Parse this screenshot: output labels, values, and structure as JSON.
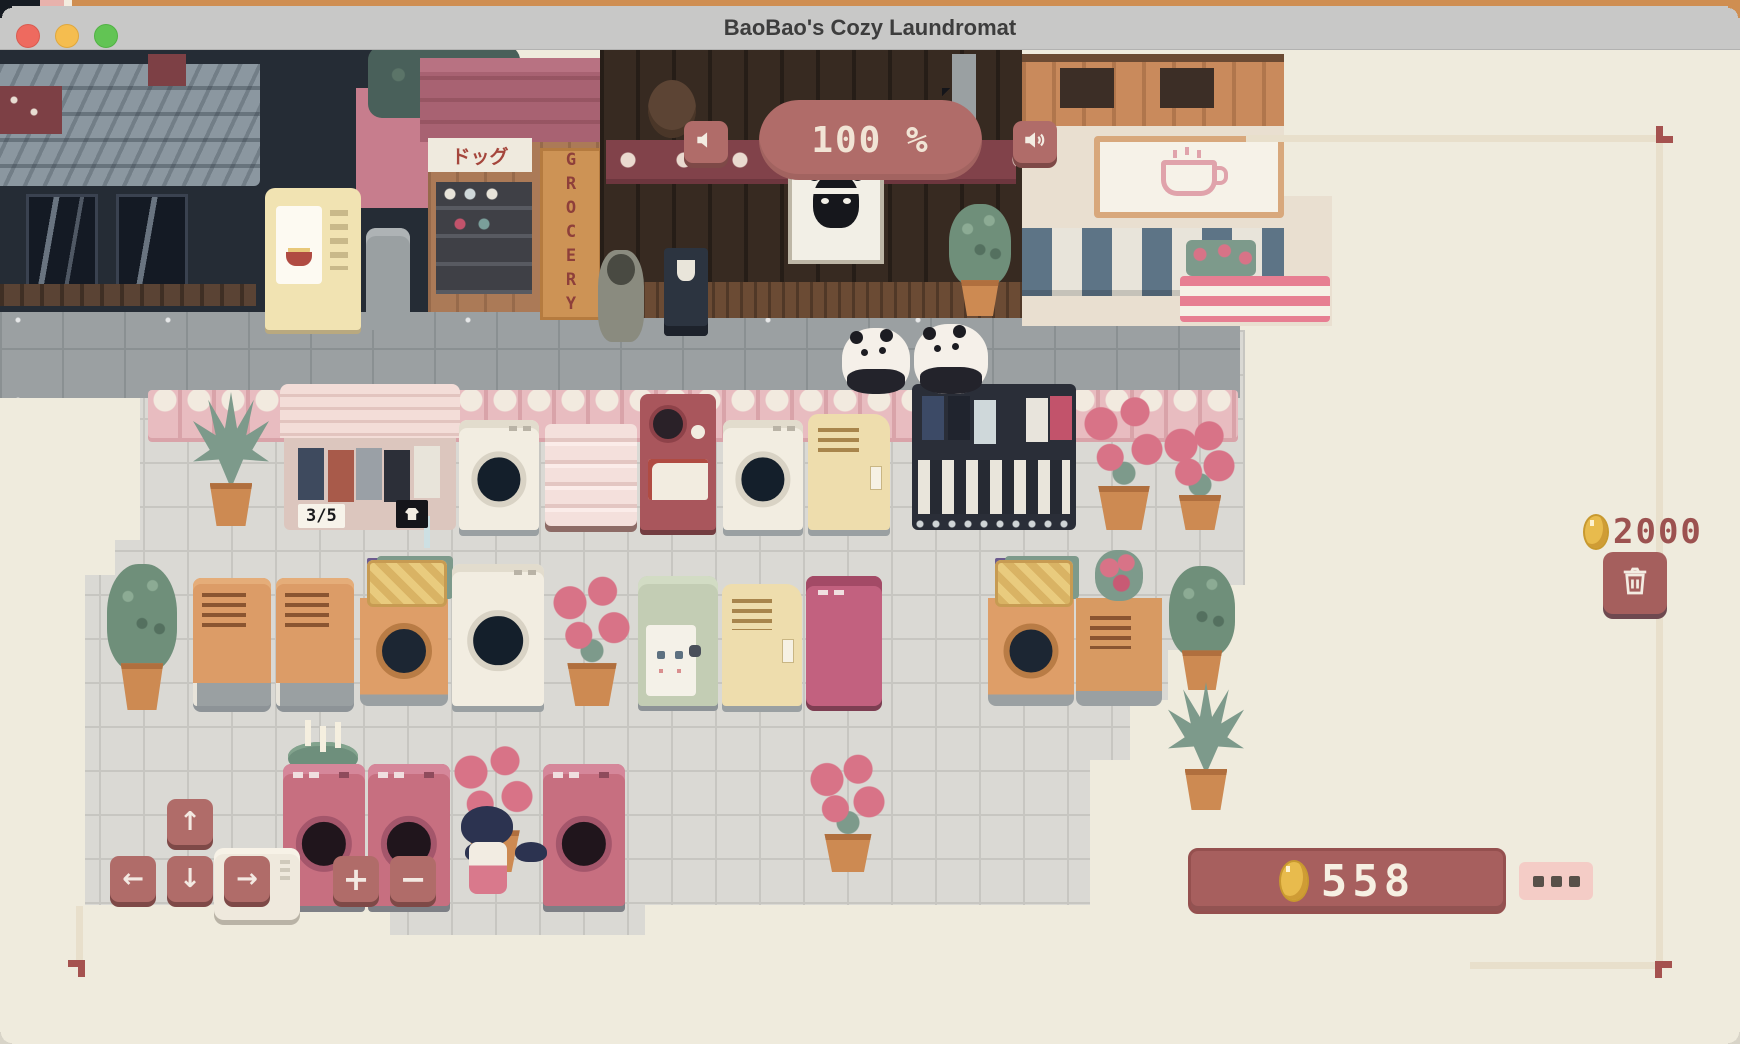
{
  "window": {
    "title": "BaoBao's Cozy Laundromat",
    "traffic_lights": [
      "close",
      "minimize",
      "zoom"
    ]
  },
  "hud": {
    "volume_percent": "100 %",
    "balance_top": "2000",
    "wallet_balance": "558",
    "shop_stock": "3/5",
    "icons": [
      "speaker-muted-icon",
      "speaker-on-icon",
      "coin-icon",
      "trash-icon",
      "ellipsis-icon"
    ]
  },
  "controls": {
    "up": "↑",
    "down": "↓",
    "left": "←",
    "right": "→",
    "plus": "+",
    "minus": "−"
  },
  "signs": {
    "grocery_vertical": "GROCERY",
    "katakana_sign": "ドッグ"
  },
  "colors": {
    "hud_red": "#a75f5e",
    "hud_button": "#b06c69",
    "coin_gold": "#e8bb4d",
    "balance_text": "#9c5250",
    "fence_pink": "#e8bcc0",
    "floor_gray": "#dad9d4",
    "sidewalk_gray": "#9ba0a2",
    "background_beige": "#efebdd",
    "bracket_red": "#a5524f"
  },
  "scene": {
    "props": [
      {
        "name": "agave-plant",
        "type": "agave",
        "x": 193,
        "y": 392,
        "w": 76,
        "h": 134
      },
      {
        "name": "clothes-shop",
        "type": "shop",
        "x": 284,
        "y": 384,
        "w": 172,
        "h": 146,
        "label": "3/5"
      },
      {
        "name": "washer",
        "type": "washer",
        "x": 459,
        "y": 420,
        "w": 80,
        "h": 110
      },
      {
        "name": "pink-shelf",
        "type": "shelf",
        "x": 545,
        "y": 424,
        "w": 92,
        "h": 102
      },
      {
        "name": "red-vending-machine",
        "type": "vend-red",
        "x": 640,
        "y": 394,
        "w": 76,
        "h": 136
      },
      {
        "name": "washer",
        "type": "washer",
        "x": 723,
        "y": 420,
        "w": 80,
        "h": 110
      },
      {
        "name": "cream-cabinet",
        "type": "locker",
        "x": 808,
        "y": 414,
        "w": 82,
        "h": 116
      },
      {
        "name": "changing-room",
        "type": "changing",
        "x": 912,
        "y": 384,
        "w": 164,
        "h": 146
      },
      {
        "name": "flower-planter",
        "type": "flowers",
        "x": 1078,
        "y": 392,
        "w": 92,
        "h": 138
      },
      {
        "name": "flower-planter",
        "type": "flowers",
        "x": 1162,
        "y": 420,
        "w": 76,
        "h": 110
      },
      {
        "name": "potted-plant",
        "type": "leafy",
        "x": 946,
        "y": 204,
        "w": 68,
        "h": 112
      },
      {
        "name": "leafy-plant",
        "type": "leafy",
        "x": 104,
        "y": 564,
        "w": 76,
        "h": 146
      },
      {
        "name": "orange-dryer",
        "type": "dryer",
        "x": 193,
        "y": 578,
        "w": 78,
        "h": 128
      },
      {
        "name": "orange-dryer",
        "type": "dryer",
        "x": 276,
        "y": 578,
        "w": 78,
        "h": 128
      },
      {
        "name": "washer-with-basket",
        "type": "washer-basket",
        "x": 360,
        "y": 560,
        "w": 88,
        "h": 146
      },
      {
        "name": "cream-washer",
        "type": "washer-cream",
        "x": 452,
        "y": 564,
        "w": 92,
        "h": 142
      },
      {
        "name": "flower-planter",
        "type": "flowers",
        "x": 548,
        "y": 572,
        "w": 88,
        "h": 134
      },
      {
        "name": "drinks-machine",
        "type": "vend-face",
        "x": 638,
        "y": 576,
        "w": 80,
        "h": 130
      },
      {
        "name": "cream-locker",
        "type": "locker",
        "x": 722,
        "y": 584,
        "w": 80,
        "h": 122
      },
      {
        "name": "pink-machine",
        "type": "machine-pink",
        "x": 806,
        "y": 576,
        "w": 76,
        "h": 130
      },
      {
        "name": "washer-with-basket",
        "type": "washer-basket",
        "x": 988,
        "y": 560,
        "w": 86,
        "h": 146
      },
      {
        "name": "orange-cabinet-flowers",
        "type": "cabinet-flower",
        "x": 1076,
        "y": 556,
        "w": 86,
        "h": 150
      },
      {
        "name": "leafy-plant",
        "type": "leafy",
        "x": 1166,
        "y": 566,
        "w": 72,
        "h": 124
      },
      {
        "name": "agave-plant",
        "type": "agave",
        "x": 1168,
        "y": 682,
        "w": 76,
        "h": 128
      },
      {
        "name": "candle-plant",
        "type": "candles",
        "x": 283,
        "y": 720,
        "w": 80,
        "h": 72
      },
      {
        "name": "pink-washer",
        "type": "washer-pink",
        "x": 283,
        "y": 764,
        "w": 82,
        "h": 142
      },
      {
        "name": "pink-washer",
        "type": "washer-pink",
        "x": 368,
        "y": 764,
        "w": 82,
        "h": 142
      },
      {
        "name": "flower-planter",
        "type": "flowers-tall",
        "x": 448,
        "y": 742,
        "w": 92,
        "h": 130
      },
      {
        "name": "pink-washer",
        "type": "washer-pink",
        "x": 543,
        "y": 764,
        "w": 82,
        "h": 142
      },
      {
        "name": "white-machine",
        "type": "machine-white",
        "x": 214,
        "y": 848,
        "w": 86,
        "h": 72
      },
      {
        "name": "flower-planter",
        "type": "flowers",
        "x": 806,
        "y": 752,
        "w": 84,
        "h": 120
      },
      {
        "name": "panda-customer",
        "type": "panda",
        "x": 842,
        "y": 328,
        "w": 68,
        "h": 66
      },
      {
        "name": "panda-customer",
        "type": "panda",
        "x": 914,
        "y": 324,
        "w": 74,
        "h": 70
      },
      {
        "name": "shopper-npc",
        "type": "npc",
        "x": 598,
        "y": 250,
        "w": 46,
        "h": 92
      },
      {
        "name": "menu-signboard",
        "type": "signboard",
        "x": 664,
        "y": 248,
        "w": 44,
        "h": 88
      },
      {
        "name": "player-character",
        "type": "girl",
        "x": 455,
        "y": 806,
        "w": 66,
        "h": 100
      }
    ]
  }
}
